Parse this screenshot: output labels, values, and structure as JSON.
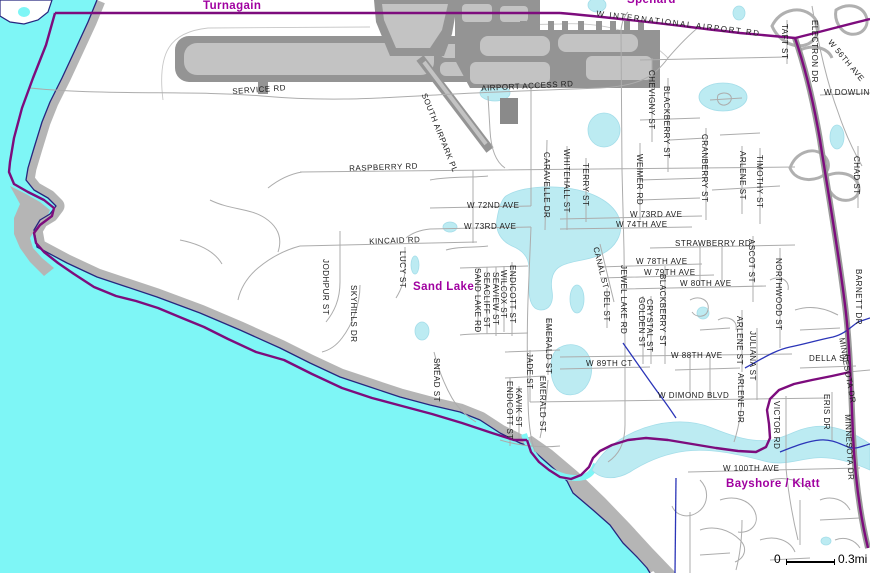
{
  "map": {
    "colors": {
      "ocean": "#7EF6F6",
      "lake": "#BCEBF2",
      "beach_gray": "#B5B5B5",
      "runway_dark": "#949494",
      "runway_light": "#C3C3C3",
      "street_gray": "#ACACAC",
      "highway_purple": "#7D0C7D",
      "creek_blue": "#2B35B8",
      "coast_outline": "#26267E",
      "street_label": "#1C1C1C",
      "place_label": "#A000A0"
    },
    "place_labels": [
      {
        "t": "Turnagain",
        "x": 203,
        "y": 0,
        "r": 0
      },
      {
        "t": "Spenard",
        "x": 627,
        "y": -6,
        "r": 0
      },
      {
        "t": "Sand Lake",
        "x": 413,
        "y": 281,
        "r": 0
      },
      {
        "t": "Bayshore / Klatt",
        "x": 726,
        "y": 478,
        "r": 0
      }
    ],
    "street_labels": [
      {
        "t": "SERVICE RD",
        "x": 232,
        "y": 87,
        "r": -4
      },
      {
        "t": "AIRPORT ACCESS RD",
        "x": 481,
        "y": 84,
        "r": -3
      },
      {
        "t": "W INTERNATIONAL AIRPORT RD",
        "x": 597,
        "y": 9,
        "r": 7,
        "s": 1.6
      },
      {
        "t": "RASPBERRY RD",
        "x": 349,
        "y": 164,
        "r": -2
      },
      {
        "t": "W 72ND AVE",
        "x": 467,
        "y": 201,
        "r": 0
      },
      {
        "t": "W 73RD AVE",
        "x": 464,
        "y": 222,
        "r": 0
      },
      {
        "t": "W 73RD AVE",
        "x": 630,
        "y": 210,
        "r": 0
      },
      {
        "t": "W 74TH AVE",
        "x": 616,
        "y": 220,
        "r": 0
      },
      {
        "t": "KINCAID RD",
        "x": 369,
        "y": 237,
        "r": -2
      },
      {
        "t": "STRAWBERRY RD",
        "x": 675,
        "y": 239,
        "r": 0
      },
      {
        "t": "W 78TH AVE",
        "x": 636,
        "y": 257,
        "r": 0
      },
      {
        "t": "W 79TH AVE",
        "x": 644,
        "y": 268,
        "r": 0
      },
      {
        "t": "W 80TH AVE",
        "x": 680,
        "y": 279,
        "r": 0
      },
      {
        "t": "W 88TH AVE",
        "x": 671,
        "y": 351,
        "r": 0
      },
      {
        "t": "W 89TH CT",
        "x": 586,
        "y": 359,
        "r": 0
      },
      {
        "t": "W DIMOND BLVD",
        "x": 658,
        "y": 391,
        "r": 0
      },
      {
        "t": "DELLA ST",
        "x": 809,
        "y": 354,
        "r": 0
      },
      {
        "t": "W 100TH AVE",
        "x": 723,
        "y": 464,
        "r": 0
      },
      {
        "t": "W DOWLING",
        "x": 824,
        "y": 88,
        "r": 0
      },
      {
        "t": "W 56TH AVE",
        "x": 833,
        "y": 38,
        "r": 50
      },
      {
        "t": "SOUTH AIRPARK PL",
        "x": 428,
        "y": 92,
        "r": 68
      },
      {
        "t": "CANAL ST",
        "x": 600,
        "y": 246,
        "r": 76
      },
      {
        "t": "CARAVELLE DR",
        "x": 551,
        "y": 152,
        "r": 90
      },
      {
        "t": "WHITEHALL ST",
        "x": 571,
        "y": 149,
        "r": 90
      },
      {
        "t": "TERRY ST",
        "x": 590,
        "y": 163,
        "r": 90
      },
      {
        "t": "WEIMER RD",
        "x": 644,
        "y": 154,
        "r": 90
      },
      {
        "t": "CHEVIGNY ST",
        "x": 656,
        "y": 70,
        "r": 90
      },
      {
        "t": "BLACKBERRY ST",
        "x": 671,
        "y": 86,
        "r": 90
      },
      {
        "t": "CRANBERRY ST",
        "x": 709,
        "y": 134,
        "r": 90
      },
      {
        "t": "ARLENE ST",
        "x": 747,
        "y": 151,
        "r": 90
      },
      {
        "t": "TIMOTHY ST",
        "x": 764,
        "y": 155,
        "r": 90
      },
      {
        "t": "TAFT ST",
        "x": 789,
        "y": 24,
        "r": 90
      },
      {
        "t": "ELECTRON DR",
        "x": 819,
        "y": 20,
        "r": 90
      },
      {
        "t": "CHAD ST",
        "x": 861,
        "y": 156,
        "r": 90
      },
      {
        "t": "NORTHWOOD ST",
        "x": 783,
        "y": 258,
        "r": 90
      },
      {
        "t": "BARNETT DR",
        "x": 863,
        "y": 269,
        "r": 90
      },
      {
        "t": "ASCOT ST",
        "x": 756,
        "y": 239,
        "r": 90
      },
      {
        "t": "JODHPUR ST",
        "x": 330,
        "y": 259,
        "r": 90
      },
      {
        "t": "SKYHILLS DR",
        "x": 358,
        "y": 285,
        "r": 90
      },
      {
        "t": "LUCY ST",
        "x": 407,
        "y": 251,
        "r": 90
      },
      {
        "t": "SNEAD ST",
        "x": 441,
        "y": 358,
        "r": 90
      },
      {
        "t": "SAND LAKE RD",
        "x": 482,
        "y": 268,
        "r": 90
      },
      {
        "t": "SEACLIFF ST",
        "x": 491,
        "y": 272,
        "r": 90
      },
      {
        "t": "SEAVIEW ST",
        "x": 500,
        "y": 272,
        "r": 90
      },
      {
        "t": "WILCOX ST",
        "x": 508,
        "y": 270,
        "r": 90
      },
      {
        "t": "ENDICOTT ST",
        "x": 517,
        "y": 265,
        "r": 90
      },
      {
        "t": "DEL ST",
        "x": 611,
        "y": 291,
        "r": 90
      },
      {
        "t": "JEWEL LAKE RD",
        "x": 628,
        "y": 265,
        "r": 90
      },
      {
        "t": "GOLDEN ST",
        "x": 646,
        "y": 297,
        "r": 90
      },
      {
        "t": "CRYSTAL ST",
        "x": 654,
        "y": 299,
        "r": 90
      },
      {
        "t": "BLACKBERRY ST",
        "x": 667,
        "y": 274,
        "r": 90
      },
      {
        "t": "EMERALD ST",
        "x": 553,
        "y": 318,
        "r": 90
      },
      {
        "t": "JADE ST",
        "x": 534,
        "y": 353,
        "r": 90
      },
      {
        "t": "EMERALD ST",
        "x": 547,
        "y": 376,
        "r": 90
      },
      {
        "t": "KAVIK ST",
        "x": 523,
        "y": 388,
        "r": 90
      },
      {
        "t": "ENDICOTT ST",
        "x": 514,
        "y": 381,
        "r": 90
      },
      {
        "t": "ARLENE ST",
        "x": 744,
        "y": 316,
        "r": 90
      },
      {
        "t": "ARLENE DR",
        "x": 745,
        "y": 373,
        "r": 90
      },
      {
        "t": "JULIANA ST",
        "x": 757,
        "y": 331,
        "r": 90
      },
      {
        "t": "VICTOR RD",
        "x": 781,
        "y": 401,
        "r": 90
      },
      {
        "t": "ERIS DR",
        "x": 831,
        "y": 394,
        "r": 90
      },
      {
        "t": "MINNESOTA DR",
        "x": 846,
        "y": 337,
        "r": 80
      },
      {
        "t": "MINNESOTA DR",
        "x": 852,
        "y": 414,
        "r": 87
      }
    ],
    "scale_bar": {
      "zero": "0",
      "distance": "0.3mi"
    }
  }
}
